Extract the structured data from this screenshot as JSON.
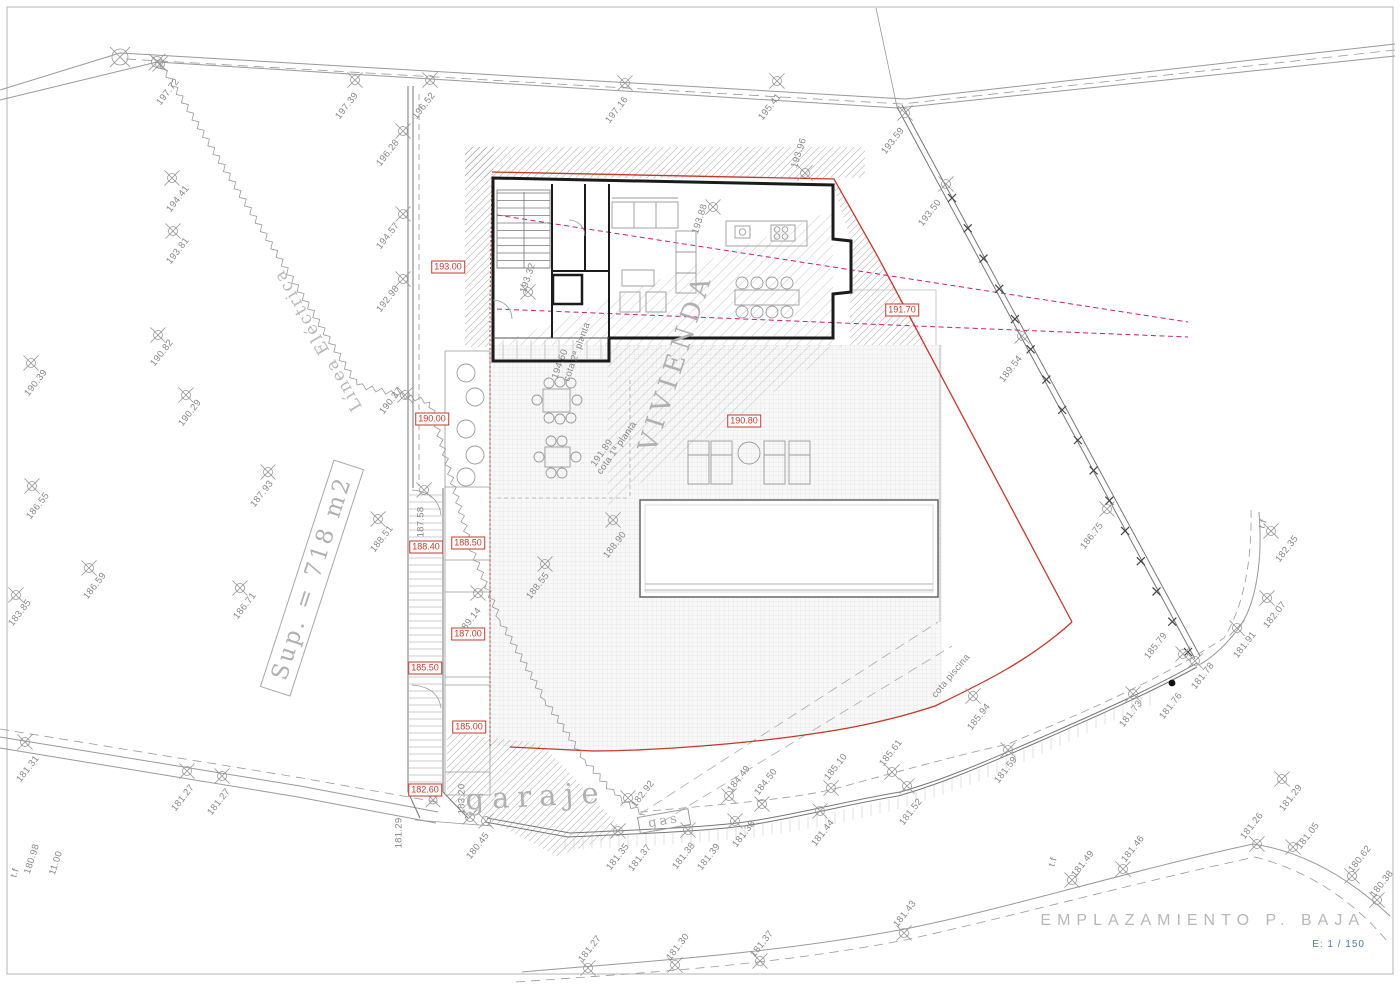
{
  "title": {
    "text": "EMPLAZAMIENTO P. BAJA",
    "scale": "E: 1 / 150"
  },
  "plan": {
    "area": "Sup. = 718 m2",
    "electric": "Línea Eléctrica",
    "building": "VIVIENDA",
    "garage": "garaje",
    "gas": "gas"
  },
  "colors": {
    "boundary_red": "#c0392b",
    "section_magenta": "#c41f7a",
    "line_gray": "#8f8f8f",
    "wall_dark": "#1b1b1b",
    "label_gray": "#878787",
    "title_gray": "#b8b8b8",
    "scale_blue": "#4a7cb5"
  },
  "level_boxes": [
    {
      "t": "193.00",
      "x": 448,
      "y": 267
    },
    {
      "t": "190.00",
      "x": 432,
      "y": 419
    },
    {
      "t": "188.40",
      "x": 426,
      "y": 547
    },
    {
      "t": "188.50",
      "x": 468,
      "y": 543
    },
    {
      "t": "187.00",
      "x": 468,
      "y": 634
    },
    {
      "t": "185.50",
      "x": 425,
      "y": 668
    },
    {
      "t": "185.00",
      "x": 469,
      "y": 727
    },
    {
      "t": "182.60",
      "x": 425,
      "y": 790
    },
    {
      "t": "191.70",
      "x": 902,
      "y": 310
    },
    {
      "t": "190.80",
      "x": 744,
      "y": 421
    }
  ],
  "spots": [
    {
      "t": "197.72",
      "x": 168,
      "y": 92,
      "m": [
        -8,
        -28
      ]
    },
    {
      "t": "197.39",
      "x": 347,
      "y": 106,
      "m": [
        8,
        -26
      ]
    },
    {
      "t": "196.52",
      "x": 424,
      "y": 106,
      "m": [
        6,
        -26
      ]
    },
    {
      "t": "197.16",
      "x": 617,
      "y": 110,
      "m": [
        8,
        -27
      ]
    },
    {
      "t": "195.41",
      "x": 770,
      "y": 107,
      "m": [
        7,
        -26
      ]
    },
    {
      "t": "193.59",
      "x": 893,
      "y": 141,
      "m": [
        12,
        -28
      ]
    },
    {
      "t": "193.50",
      "x": 930,
      "y": 213,
      "m": [
        16,
        -29
      ]
    },
    {
      "t": "196.28",
      "x": 388,
      "y": 153,
      "m": [
        15,
        -22
      ]
    },
    {
      "t": "194.41",
      "x": 178,
      "y": 199,
      "m": [
        -6,
        -21
      ]
    },
    {
      "t": "193.81",
      "x": 178,
      "y": 251,
      "m": [
        -5,
        -20
      ]
    },
    {
      "t": "194.57",
      "x": 388,
      "y": 236,
      "m": [
        15,
        -22
      ]
    },
    {
      "t": "192.98",
      "x": 388,
      "y": 299,
      "m": [
        15,
        -20
      ]
    },
    {
      "t": "190.82",
      "x": 162,
      "y": 353,
      "m": [
        -4,
        -18
      ]
    },
    {
      "t": "190.39",
      "x": 36,
      "y": 383,
      "m": [
        -5,
        -20
      ]
    },
    {
      "t": "190.29",
      "x": 190,
      "y": 413,
      "m": [
        -4,
        -18
      ]
    },
    {
      "t": "190.37",
      "x": 391,
      "y": 401,
      "m": [
        14,
        -6
      ]
    },
    {
      "t": "187.93",
      "x": 262,
      "y": 494,
      "m": [
        6,
        -22
      ]
    },
    {
      "t": "186.55",
      "x": 38,
      "y": 506,
      "m": [
        -6,
        -20
      ]
    },
    {
      "t": "188.51",
      "x": 382,
      "y": 539,
      "m": [
        -4,
        -20
      ]
    },
    {
      "t": "187.58",
      "x": 421,
      "y": 522,
      "r": -90,
      "m": [
        3,
        -32
      ]
    },
    {
      "t": "188.90",
      "x": 615,
      "y": 545,
      "m": [
        -2,
        -25
      ]
    },
    {
      "t": "188.55",
      "x": 538,
      "y": 586,
      "m": [
        7,
        -22
      ]
    },
    {
      "t": "186.59",
      "x": 95,
      "y": 586,
      "m": [
        -6,
        -18
      ]
    },
    {
      "t": "183.85",
      "x": 20,
      "y": 613,
      "m": [
        -4,
        -18
      ]
    },
    {
      "t": "186.71",
      "x": 245,
      "y": 606,
      "m": [
        -5,
        -18
      ]
    },
    {
      "t": "189.14",
      "x": 470,
      "y": 621,
      "m": [
        8,
        -28
      ]
    },
    {
      "t": "189.54",
      "x": 1011,
      "y": 369,
      "m": [
        11,
        -33
      ]
    },
    {
      "t": "186.75",
      "x": 1092,
      "y": 536,
      "m": [
        15,
        -27
      ]
    },
    {
      "t": "t.f",
      "x": 1263,
      "y": 524,
      "r": -72,
      "m": null
    },
    {
      "t": "182.35",
      "x": 1287,
      "y": 549,
      "m": [
        -16,
        -18
      ]
    },
    {
      "t": "182.07",
      "x": 1275,
      "y": 615,
      "m": [
        -8,
        -17
      ]
    },
    {
      "t": "181.91",
      "x": 1245,
      "y": 645,
      "m": [
        -8,
        -17
      ]
    },
    {
      "t": "185.79",
      "x": 1156,
      "y": 646,
      "m": [
        27,
        8
      ]
    },
    {
      "t": "181.78",
      "x": 1203,
      "y": 676,
      "m": [
        -8,
        -15
      ]
    },
    {
      "t": "181.76",
      "x": 1171,
      "y": 706,
      "m": null
    },
    {
      "t": "181.73",
      "x": 1131,
      "y": 714,
      "m": [
        2,
        -20
      ]
    },
    {
      "t": "cota piscina",
      "x": 951,
      "y": 676,
      "r": -50,
      "m": null
    },
    {
      "t": "185.94",
      "x": 979,
      "y": 717,
      "m": [
        -6,
        -21
      ]
    },
    {
      "t": "181.59",
      "x": 1006,
      "y": 770,
      "m": [
        2,
        -20
      ]
    },
    {
      "t": "185.61",
      "x": 891,
      "y": 753,
      "m": [
        1,
        19
      ]
    },
    {
      "t": "185.10",
      "x": 836,
      "y": 767,
      "m": [
        -5,
        21
      ]
    },
    {
      "t": "181.52",
      "x": 911,
      "y": 812,
      "m": [
        -4,
        -26
      ]
    },
    {
      "t": "184.50",
      "x": 766,
      "y": 782,
      "m": [
        -4,
        22
      ]
    },
    {
      "t": "184.49",
      "x": 739,
      "y": 779,
      "m": [
        -10,
        17
      ]
    },
    {
      "t": "181.44",
      "x": 823,
      "y": 833,
      "m": [
        -3,
        -22
      ]
    },
    {
      "t": "181.38",
      "x": 744,
      "y": 834,
      "m": [
        -9,
        -13
      ]
    },
    {
      "t": "182.92",
      "x": 643,
      "y": 794,
      "m": [
        -15,
        4
      ]
    },
    {
      "t": "181.35",
      "x": 618,
      "y": 857,
      "m": [
        0,
        -26
      ]
    },
    {
      "t": "181.37",
      "x": 640,
      "y": 858,
      "m": null
    },
    {
      "t": "181.38",
      "x": 684,
      "y": 856,
      "m": [
        4,
        -26
      ]
    },
    {
      "t": "181.39",
      "x": 709,
      "y": 857,
      "m": null
    },
    {
      "t": "180.45",
      "x": 478,
      "y": 846,
      "m": null
    },
    {
      "t": "183.20",
      "x": 462,
      "y": 799,
      "r": -90,
      "m": null
    },
    {
      "t": "181.29",
      "x": 399,
      "y": 833,
      "r": -90,
      "m": null
    },
    {
      "t": "180.98",
      "x": 32,
      "y": 859,
      "r": -72,
      "m": null
    },
    {
      "t": "11.00",
      "x": 56,
      "y": 863,
      "r": -72,
      "m": null
    },
    {
      "t": "t.f",
      "x": 15,
      "y": 873,
      "r": -72,
      "m": null
    },
    {
      "t": "181.31",
      "x": 28,
      "y": 769,
      "m": [
        -3,
        -27
      ]
    },
    {
      "t": "181.27",
      "x": 183,
      "y": 798,
      "m": [
        4,
        -27
      ]
    },
    {
      "t": "181.27",
      "x": 219,
      "y": 802,
      "m": [
        3,
        -26
      ]
    },
    {
      "t": "181.43",
      "x": 905,
      "y": 914,
      "m": [
        -1,
        19
      ]
    },
    {
      "t": "181.27",
      "x": 590,
      "y": 949,
      "m": [
        -2,
        19
      ]
    },
    {
      "t": "181.30",
      "x": 678,
      "y": 947,
      "m": [
        -3,
        18
      ]
    },
    {
      "t": "181.37",
      "x": 762,
      "y": 944,
      "m": [
        -2,
        17
      ]
    },
    {
      "t": "t.f",
      "x": 1053,
      "y": 862,
      "r": -72,
      "m": null
    },
    {
      "t": "181.49",
      "x": 1083,
      "y": 864,
      "m": [
        -11,
        16
      ]
    },
    {
      "t": "181.46",
      "x": 1133,
      "y": 849,
      "m": [
        -10,
        20
      ]
    },
    {
      "t": "181.26",
      "x": 1252,
      "y": 826,
      "m": [
        5,
        18
      ]
    },
    {
      "t": "181.29",
      "x": 1291,
      "y": 798,
      "m": [
        -9,
        -19
      ]
    },
    {
      "t": "181.05",
      "x": 1308,
      "y": 836,
      "m": [
        -15,
        11
      ]
    },
    {
      "t": "180.62",
      "x": 1360,
      "y": 859,
      "m": [
        -8,
        17
      ]
    },
    {
      "t": "180.38",
      "x": 1382,
      "y": 884,
      "m": [
        -5,
        16
      ]
    },
    {
      "t": "193.96",
      "x": 799,
      "y": 153,
      "r": -72,
      "m": [
        6,
        20
      ]
    },
    {
      "t": "193.32",
      "x": 528,
      "y": 278,
      "r": -72,
      "m": [
        0,
        14
      ]
    },
    {
      "t": "193.88",
      "x": 700,
      "y": 219,
      "r": -72,
      "m": [
        13,
        -12
      ]
    },
    {
      "t": "194.60",
      "x": 560,
      "y": 364,
      "r": -70,
      "m": null
    },
    {
      "t": "cota 2ª planta",
      "x": 577,
      "y": 352,
      "r": -70,
      "m": null
    },
    {
      "t": "191.89",
      "x": 602,
      "y": 453,
      "r": -55,
      "m": null
    },
    {
      "t": "cota 1ª planta",
      "x": 617,
      "y": 448,
      "r": -55,
      "m": null
    }
  ]
}
